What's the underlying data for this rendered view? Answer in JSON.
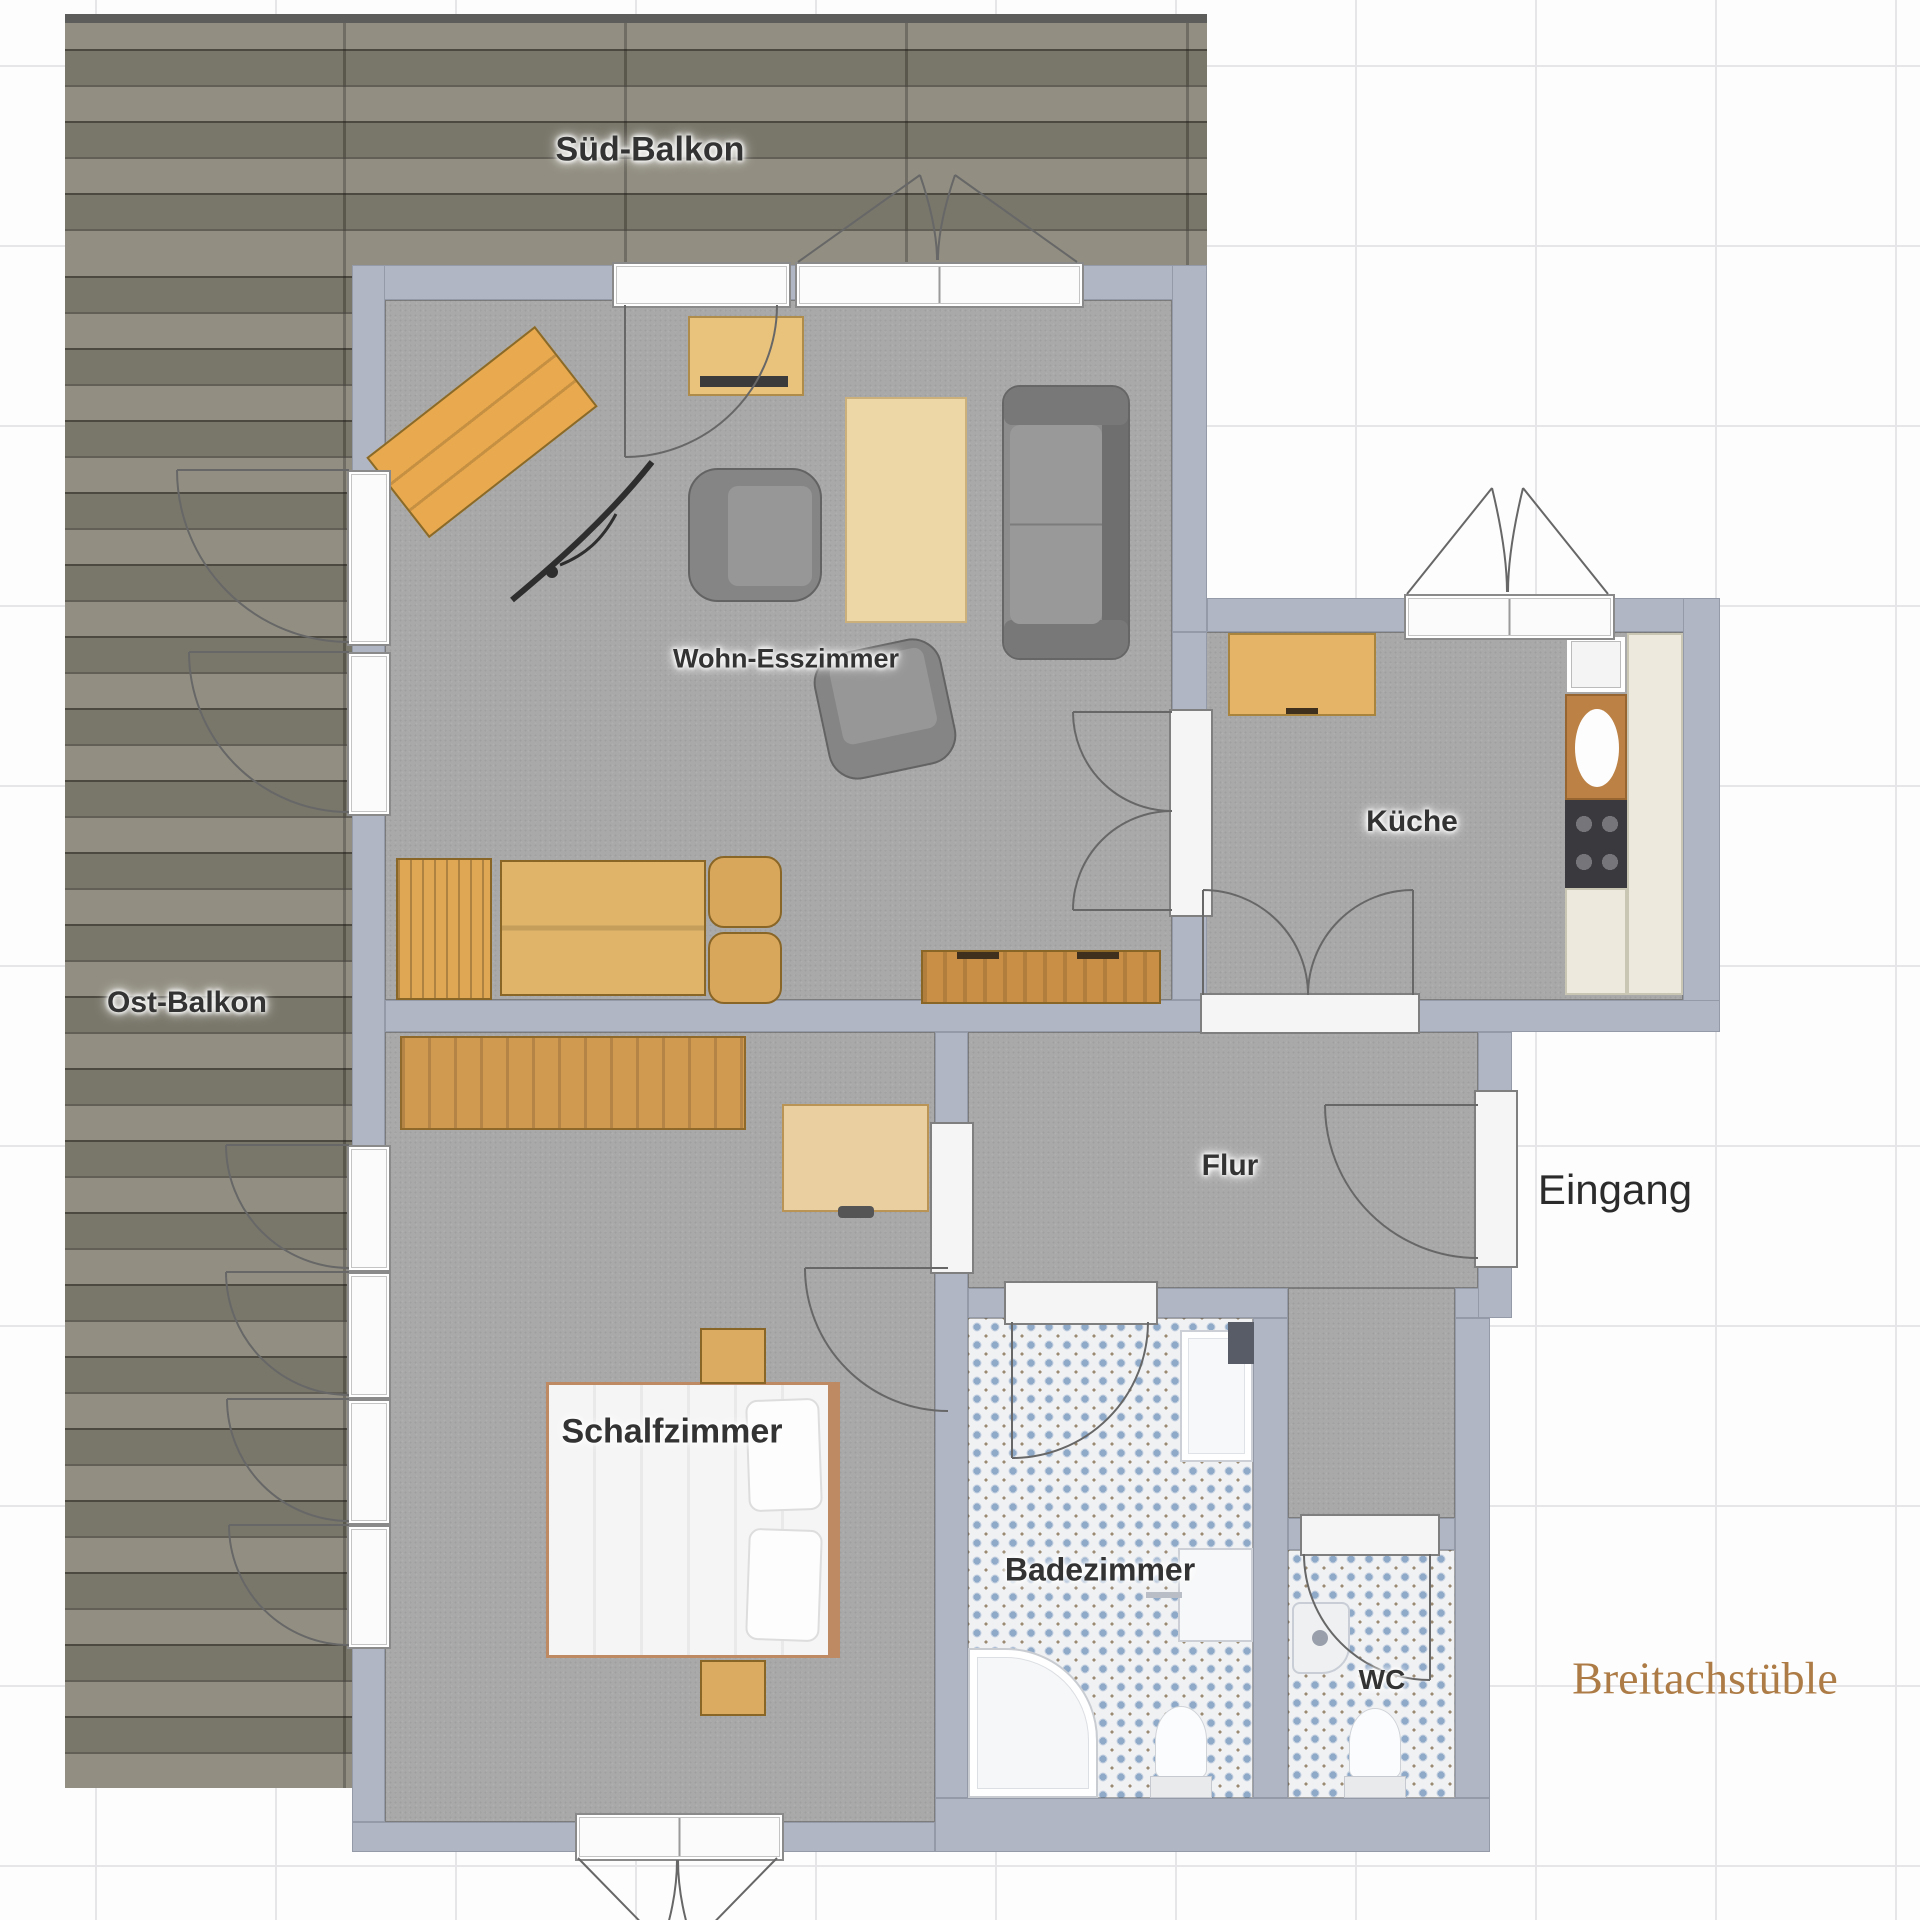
{
  "plan_title": "Breitachstüble",
  "labels": {
    "sued_balkon": "Süd-Balkon",
    "ost_balkon": "Ost-Balkon",
    "wohn_esszimmer": "Wohn-Esszimmer",
    "kueche": "Küche",
    "flur": "Flur",
    "eingang": "Eingang",
    "schlafzimmer": "Schalfzimmer",
    "badezimmer": "Badezimmer",
    "wc": "WC",
    "title": "Breitachstüble"
  },
  "colors": {
    "wall": "#b0b6c4",
    "floor_carpet": "#a9a9a9",
    "deck_wood": "#8a8779",
    "tile_base": "#f0f1f3",
    "tile_dot": "#8fa9c9",
    "furniture_wood": "#e0b065",
    "room_label": "#333333",
    "entry_label": "#2b2b2b",
    "title_label": "#ad7c46"
  }
}
